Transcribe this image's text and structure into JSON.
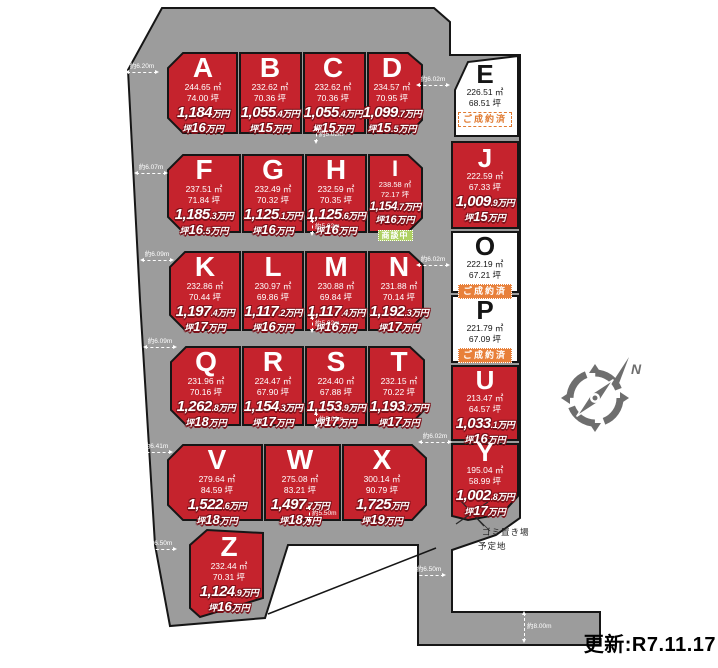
{
  "meta": {
    "update_label": "更新:R7.11.17"
  },
  "labels": {
    "tsubo_prefix": "坪",
    "north": "N",
    "trash_line1": "ゴミ置き場",
    "trash_line2": "予定地"
  },
  "badges": {
    "sold": "ご成約済",
    "negotiating": "商談中"
  },
  "colors": {
    "plot_red": "#c5232d",
    "land_gray": "#9c9c9c",
    "sold_orange": "#e8803a",
    "negotiating_green": "#afd163",
    "price_outline": "#7c1119"
  },
  "plots": [
    {
      "id": "A",
      "area_m2": "244.65 ㎡",
      "area_tsubo": "74.00 坪",
      "price_big": "1,184",
      "price_small": "万円",
      "tsubo_big": "16",
      "tsubo_small": "万円",
      "status": "for_sale"
    },
    {
      "id": "B",
      "area_m2": "232.62 ㎡",
      "area_tsubo": "70.36 坪",
      "price_big": "1,055",
      "price_small": ".4万円",
      "tsubo_big": "15",
      "tsubo_small": "万円",
      "status": "for_sale"
    },
    {
      "id": "C",
      "area_m2": "232.62 ㎡",
      "area_tsubo": "70.36 坪",
      "price_big": "1,055",
      "price_small": ".4万円",
      "tsubo_big": "15",
      "tsubo_small": "万円",
      "status": "for_sale"
    },
    {
      "id": "D",
      "area_m2": "234.57 ㎡",
      "area_tsubo": "70.95 坪",
      "price_big": "1,099",
      "price_small": ".7万円",
      "tsubo_big": "15",
      "tsubo_small": ".5万円",
      "status": "for_sale"
    },
    {
      "id": "E",
      "area_m2": "226.51 ㎡",
      "area_tsubo": "68.51 坪",
      "status": "sold",
      "badge_style": "outline"
    },
    {
      "id": "F",
      "area_m2": "237.51 ㎡",
      "area_tsubo": "71.84 坪",
      "price_big": "1,185",
      "price_small": ".3万円",
      "tsubo_big": "16",
      "tsubo_small": ".5万円",
      "status": "for_sale"
    },
    {
      "id": "G",
      "area_m2": "232.49 ㎡",
      "area_tsubo": "70.32 坪",
      "price_big": "1,125",
      "price_small": ".1万円",
      "tsubo_big": "16",
      "tsubo_small": "万円",
      "status": "for_sale"
    },
    {
      "id": "H",
      "area_m2": "232.59 ㎡",
      "area_tsubo": "70.35 坪",
      "price_big": "1,125",
      "price_small": ".6万円",
      "tsubo_big": "16",
      "tsubo_small": "万円",
      "status": "for_sale"
    },
    {
      "id": "I",
      "area_m2": "238.58 ㎡",
      "area_tsubo": "72.17 坪",
      "price_big": "1,154",
      "price_small": ".7万円",
      "tsubo_big": "16",
      "tsubo_small": "万円",
      "status": "negotiating"
    },
    {
      "id": "J",
      "area_m2": "222.59 ㎡",
      "area_tsubo": "67.33 坪",
      "price_big": "1,009",
      "price_small": ".9万円",
      "tsubo_big": "15",
      "tsubo_small": "万円",
      "status": "for_sale"
    },
    {
      "id": "K",
      "area_m2": "232.86 ㎡",
      "area_tsubo": "70.44 坪",
      "price_big": "1,197",
      "price_small": ".4万円",
      "tsubo_big": "17",
      "tsubo_small": "万円",
      "status": "for_sale"
    },
    {
      "id": "L",
      "area_m2": "230.97 ㎡",
      "area_tsubo": "69.86 坪",
      "price_big": "1,117",
      "price_small": ".2万円",
      "tsubo_big": "16",
      "tsubo_small": "万円",
      "status": "for_sale"
    },
    {
      "id": "M",
      "area_m2": "230.88 ㎡",
      "area_tsubo": "69.84 坪",
      "price_big": "1,117",
      "price_small": ".4万円",
      "tsubo_big": "16",
      "tsubo_small": "万円",
      "status": "for_sale"
    },
    {
      "id": "N",
      "area_m2": "231.88 ㎡",
      "area_tsubo": "70.14 坪",
      "price_big": "1,192",
      "price_small": ".3万円",
      "tsubo_big": "17",
      "tsubo_small": "万円",
      "status": "for_sale"
    },
    {
      "id": "O",
      "area_m2": "222.19 ㎡",
      "area_tsubo": "67.21 坪",
      "status": "sold",
      "badge_style": "fill"
    },
    {
      "id": "P",
      "area_m2": "221.79 ㎡",
      "area_tsubo": "67.09 坪",
      "status": "sold",
      "badge_style": "fill"
    },
    {
      "id": "Q",
      "area_m2": "231.96 ㎡",
      "area_tsubo": "70.16 坪",
      "price_big": "1,262",
      "price_small": ".8万円",
      "tsubo_big": "18",
      "tsubo_small": "万円",
      "status": "for_sale"
    },
    {
      "id": "R",
      "area_m2": "224.47 ㎡",
      "area_tsubo": "67.90 坪",
      "price_big": "1,154",
      "price_small": ".3万円",
      "tsubo_big": "17",
      "tsubo_small": "万円",
      "status": "for_sale"
    },
    {
      "id": "S",
      "area_m2": "224.40 ㎡",
      "area_tsubo": "67.88 坪",
      "price_big": "1,153",
      "price_small": ".9万円",
      "tsubo_big": "17",
      "tsubo_small": "万円",
      "status": "for_sale"
    },
    {
      "id": "T",
      "area_m2": "232.15 ㎡",
      "area_tsubo": "70.22 坪",
      "price_big": "1,193",
      "price_small": ".7万円",
      "tsubo_big": "17",
      "tsubo_small": "万円",
      "status": "for_sale"
    },
    {
      "id": "U",
      "area_m2": "213.47 ㎡",
      "area_tsubo": "64.57 坪",
      "price_big": "1,033",
      "price_small": ".1万円",
      "tsubo_big": "16",
      "tsubo_small": "万円",
      "status": "for_sale"
    },
    {
      "id": "V",
      "area_m2": "279.64 ㎡",
      "area_tsubo": "84.59 坪",
      "price_big": "1,522",
      "price_small": ".6万円",
      "tsubo_big": "18",
      "tsubo_small": "万円",
      "status": "for_sale"
    },
    {
      "id": "W",
      "area_m2": "275.08 ㎡",
      "area_tsubo": "83.21 坪",
      "price_big": "1,497",
      "price_small": ".7万円",
      "tsubo_big": "18",
      "tsubo_small": "万円",
      "status": "for_sale"
    },
    {
      "id": "X",
      "area_m2": "300.14 ㎡",
      "area_tsubo": "90.79 坪",
      "price_big": "1,725",
      "price_small": "万円",
      "tsubo_big": "19",
      "tsubo_small": "万円",
      "status": "for_sale"
    },
    {
      "id": "Y",
      "area_m2": "195.04 ㎡",
      "area_tsubo": "58.99 坪",
      "price_big": "1,002",
      "price_small": ".8万円",
      "tsubo_big": "17",
      "tsubo_small": "万円",
      "status": "for_sale"
    },
    {
      "id": "Z",
      "area_m2": "232.44 ㎡",
      "area_tsubo": "70.31 坪",
      "price_big": "1,124",
      "price_small": ".9万円",
      "tsubo_big": "16",
      "tsubo_small": "万円",
      "status": "for_sale"
    }
  ],
  "dimensions": [
    "約6.20m",
    "約6.07m",
    "約6.09m",
    "約6.09m",
    "約6.41m",
    "約6.50m",
    "約6.02m",
    "約6.02m",
    "約6.02m",
    "約6.50m",
    "約5.02m",
    "約5.02m",
    "約5.02m",
    "約5.02m",
    "約5.50m",
    "約8.00m"
  ]
}
